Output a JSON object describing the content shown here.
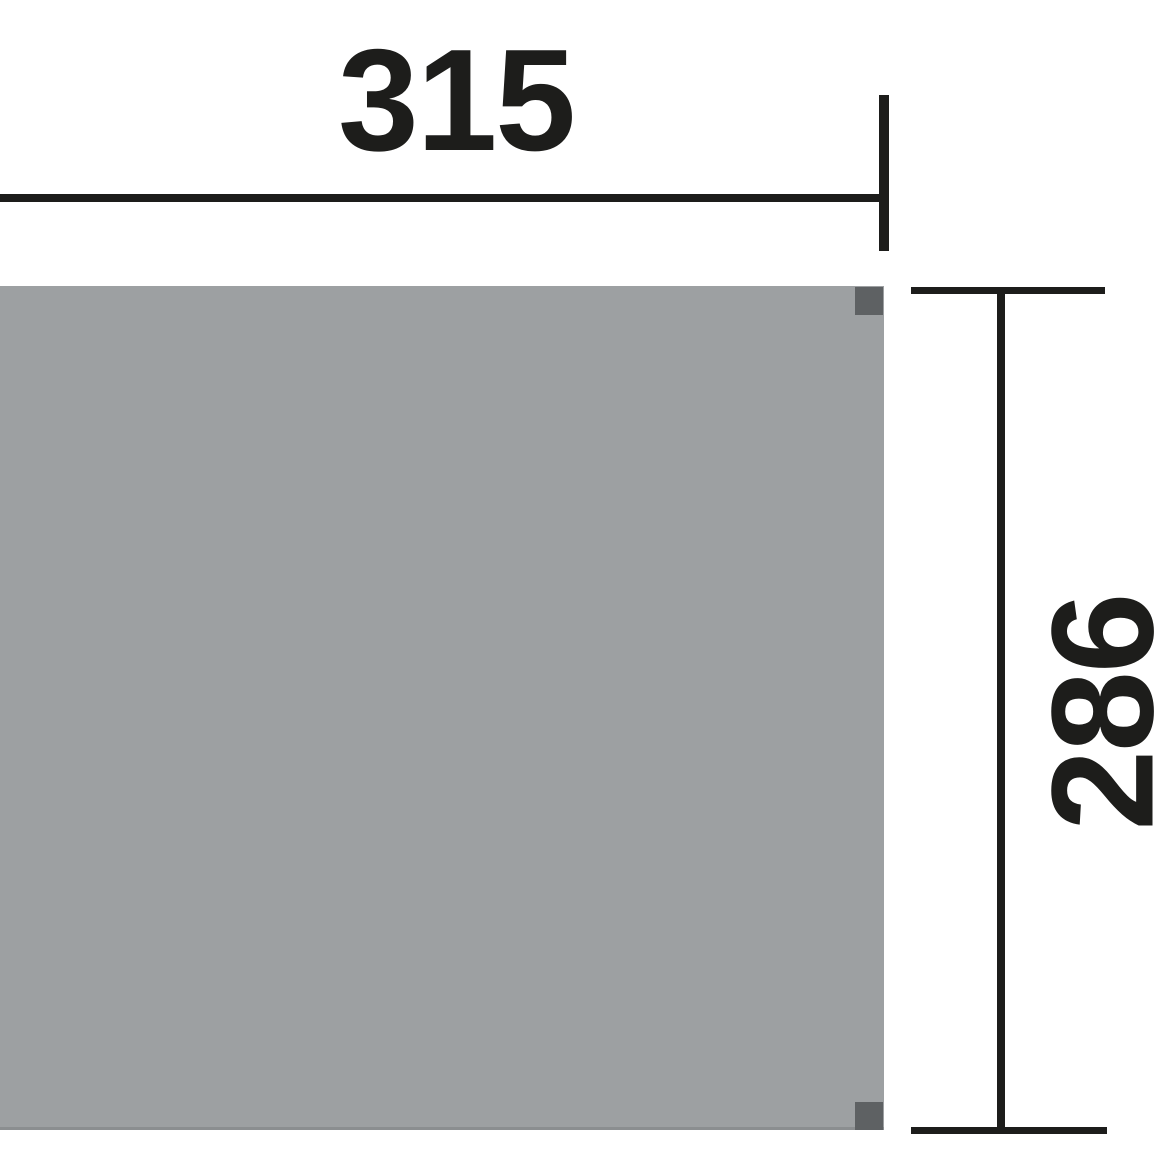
{
  "diagram": {
    "type": "technical-dimension-drawing",
    "subject": "rectangular floor panel plan view with corner posts",
    "dimensions": {
      "width_label": "315",
      "height_label": "286"
    },
    "colors": {
      "background": "#ffffff",
      "panel_fill": "#9da0a2",
      "panel_edge": "#8b8e90",
      "corner_post_fill": "#5e6163",
      "dimension_line": "#1d1d1b"
    }
  }
}
